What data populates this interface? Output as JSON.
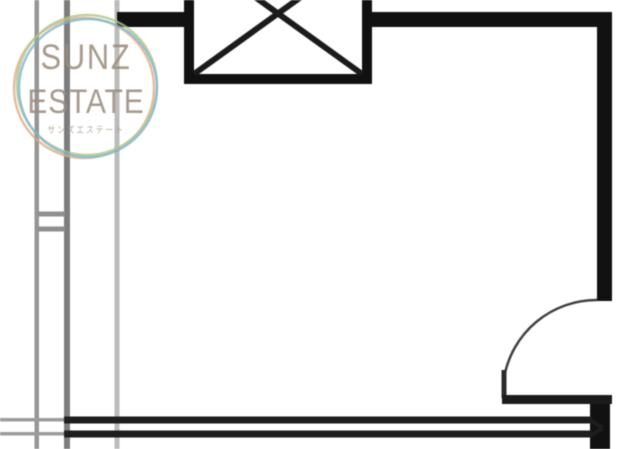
{
  "logo": {
    "line1": "SUNZ",
    "line2": "ESTATE",
    "subtitle": "サンズエステート",
    "text_color": "#9b8d7d",
    "rings": [
      {
        "cx": 84,
        "cy": 88,
        "r": 70,
        "color": "#e0a87e"
      },
      {
        "cx": 87,
        "cy": 85,
        "r": 70,
        "color": "#aec57d"
      },
      {
        "cx": 88,
        "cy": 88,
        "r": 69,
        "color": "#76b4cc"
      }
    ]
  },
  "floorplan": {
    "background": "#ffffff",
    "wall_color": "#111111",
    "elements": [
      {
        "name": "left-pipe-line-1",
        "type": "rect",
        "x": 34.5,
        "y": 0,
        "w": 4.5,
        "h": 449,
        "fill": "#969696"
      },
      {
        "name": "left-pipe-line-2",
        "type": "rect",
        "x": 64,
        "y": 0,
        "w": 6,
        "h": 449,
        "fill": "#7d7d7d"
      },
      {
        "name": "left-pipe-line-3",
        "type": "rect",
        "x": 114.5,
        "y": 0,
        "w": 5,
        "h": 449,
        "fill": "#bcbcbc"
      },
      {
        "name": "left-wall-window-mark-1",
        "type": "rect",
        "x": 38,
        "y": 211.5,
        "w": 27,
        "h": 5,
        "fill": "#8f8f8f"
      },
      {
        "name": "left-wall-window-mark-2",
        "type": "rect",
        "x": 38,
        "y": 226.5,
        "w": 27,
        "h": 5,
        "fill": "#8f8f8f"
      },
      {
        "name": "shaft-box",
        "type": "rect",
        "x": 189,
        "y": -52,
        "w": 178,
        "h": 131,
        "fill": "#ffffff",
        "stroke": "#111111",
        "sw": 10
      },
      {
        "name": "shaft-diagonal-1",
        "type": "line",
        "x1": 194,
        "y1": -47,
        "x2": 362,
        "y2": 74,
        "stroke": "#1b1b1b",
        "sw": 6
      },
      {
        "name": "shaft-diagonal-2",
        "type": "line",
        "x1": 362,
        "y1": -47,
        "x2": 194,
        "y2": 74,
        "stroke": "#1b1b1b",
        "sw": 6
      },
      {
        "name": "top-wall-left",
        "type": "rect",
        "x": 117,
        "y": 12,
        "w": 77,
        "h": 15,
        "fill": "#111111"
      },
      {
        "name": "top-wall-right",
        "type": "rect",
        "x": 363,
        "y": 12,
        "w": 249,
        "h": 15,
        "fill": "#111111"
      },
      {
        "name": "right-wall-upper",
        "type": "rect",
        "x": 597,
        "y": 12,
        "w": 15,
        "h": 289,
        "fill": "#111111"
      },
      {
        "name": "door-swing-arc",
        "type": "path",
        "d": "M 597 300 A 94 94 0 0 0 504 378",
        "stroke": "#3f3f3f",
        "sw": 2.5
      },
      {
        "name": "door-panel",
        "type": "rect",
        "x": 501.5,
        "y": 370,
        "w": 5,
        "h": 28,
        "fill": "#2b2b2b"
      },
      {
        "name": "door-threshold",
        "type": "rect",
        "x": 502,
        "y": 395,
        "w": 110,
        "h": 9,
        "fill": "#1b1b1b"
      },
      {
        "name": "right-wall-lower",
        "type": "rect",
        "x": 590,
        "y": 404,
        "w": 20,
        "h": 45,
        "fill": "#111111"
      },
      {
        "name": "balcony-rail-top-ext",
        "type": "rect",
        "x": 0,
        "y": 418,
        "w": 67,
        "h": 3.5,
        "fill": "#9c9c9c"
      },
      {
        "name": "balcony-rail-bottom-ext",
        "type": "rect",
        "x": 0,
        "y": 432,
        "w": 67,
        "h": 3.5,
        "fill": "#9c9c9c"
      },
      {
        "name": "balcony-rail-top",
        "type": "rect",
        "x": 64,
        "y": 416.5,
        "w": 528,
        "h": 7,
        "fill": "#1e1e1e"
      },
      {
        "name": "balcony-rail-bottom",
        "type": "rect",
        "x": 64,
        "y": 430.5,
        "w": 528,
        "h": 7,
        "fill": "#1e1e1e"
      },
      {
        "name": "rail-end-chevron-1",
        "type": "line",
        "x1": 590,
        "y1": 420,
        "x2": 603,
        "y2": 428,
        "stroke": "#1e1e1e",
        "sw": 4
      },
      {
        "name": "rail-end-chevron-2",
        "type": "line",
        "x1": 590,
        "y1": 436,
        "x2": 603,
        "y2": 428,
        "stroke": "#1e1e1e",
        "sw": 4
      }
    ]
  }
}
